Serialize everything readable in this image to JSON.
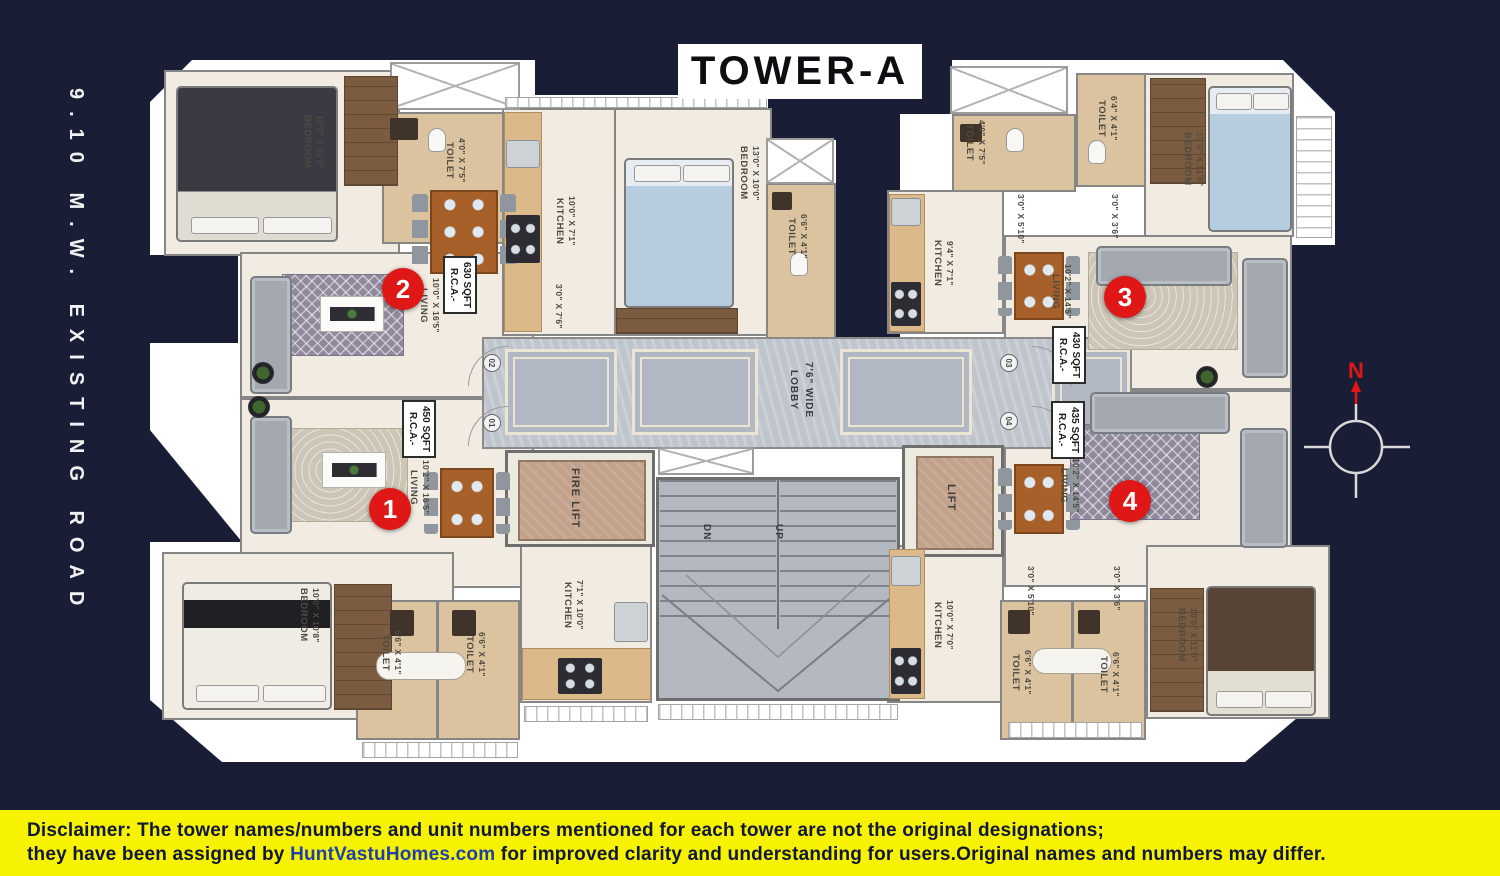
{
  "title": "TOWER-A",
  "road_label": "9.10 M.W. EXISTING ROAD",
  "compass": {
    "north": "N"
  },
  "markers": {
    "m1": "1",
    "m2": "2",
    "m3": "3",
    "m4": "4"
  },
  "doors": {
    "d01": "01",
    "d02": "02",
    "d03": "03",
    "d04": "04"
  },
  "core": {
    "lobby_name": "LOBBY",
    "lobby_dims": "7'6\" WIDE",
    "fire_lift": "FIRE LIFT",
    "lift": "LIFT",
    "stairs_dn": "DN",
    "stairs_up": "UP"
  },
  "rooms": {
    "bedroom_tl": {
      "name": "BEDROOM",
      "dims": "10'0\" X 12'0\""
    },
    "toilet_tl": {
      "name": "TOILET",
      "dims": "4'0\" X 7'5\""
    },
    "living_u2": {
      "name": "LIVING",
      "dims": "10'0\" X 16'5\""
    },
    "rca_u2": {
      "name": "R.C.A.-",
      "dims": "630 SQFT"
    },
    "kitchen_u2": {
      "name": "KITCHEN",
      "dims": "10'0\" X 7'1\""
    },
    "pass_u2": {
      "dims": "3'0\" X 7'6\""
    },
    "bedroom_tm": {
      "name": "BEDROOM",
      "dims": "13'0\" X 10'0\""
    },
    "toilet_tm": {
      "name": "TOILET",
      "dims": "6'6\" X 4'1\""
    },
    "toilet_tr1": {
      "name": "TOILET",
      "dims": "4'0\" X 7'5\""
    },
    "toilet_tr2": {
      "name": "TOILET",
      "dims": "6'4\" X 4'1\""
    },
    "bedroom_tr": {
      "name": "BEDROOM",
      "dims": "10'0\" X 11'0\""
    },
    "kitchen_u3": {
      "name": "KITCHEN",
      "dims": "9'4\" X 7'1\""
    },
    "pass_u3a": {
      "dims": "3'0\" X 5'10\""
    },
    "pass_u3b": {
      "dims": "3'0\" X 3'6\""
    },
    "living_u3": {
      "name": "LIVING",
      "dims": "10'2\" X 14'5\""
    },
    "rca_u3": {
      "name": "R.C.A.-",
      "dims": "430 SQFT"
    },
    "living_u1": {
      "name": "LIVING",
      "dims": "10'2\" X 16'5\""
    },
    "rca_u1": {
      "name": "R.C.A.-",
      "dims": "450 SQFT"
    },
    "living_u4": {
      "name": "LIVING",
      "dims": "10'2\" X 14'5\""
    },
    "rca_u4": {
      "name": "R.C.A.-",
      "dims": "435 SQFT"
    },
    "bedroom_bl": {
      "name": "BEDROOM",
      "dims": "10'0\" X 10'8\""
    },
    "toilet_bl1": {
      "name": "TOILET",
      "dims": "6'6\" X 4'1\""
    },
    "toilet_bl2": {
      "name": "TOILET",
      "dims": "6'6\" X 4'1\""
    },
    "kitchen_u1": {
      "name": "KITCHEN",
      "dims": "7'1\" X 10'0\""
    },
    "kitchen_u4": {
      "name": "KITCHEN",
      "dims": "10'0\" X 7'0\""
    },
    "pass_u4a": {
      "dims": "3'0\" X 5'10\""
    },
    "pass_u4b": {
      "dims": "3'0\" X 3'6\""
    },
    "toilet_br1": {
      "name": "TOILET",
      "dims": "6'6\" X 4'1\""
    },
    "toilet_br2": {
      "name": "TOILET",
      "dims": "6'6\" X 4'1\""
    },
    "bedroom_br": {
      "name": "BEDROOM",
      "dims": "10'0\" X 11'0\""
    }
  },
  "disclaimer": {
    "prefix": "Disclaimer:",
    "text1": " The tower names/numbers and unit numbers mentioned for each tower are not the original designations;",
    "text2": "they have been assigned by ",
    "link": "HuntVastuHomes.com",
    "text3": " for improved clarity and understanding for users.Original names and numbers may differ."
  },
  "colors": {
    "accent_red": "#e01717",
    "banner_yellow": "#f7f200",
    "navy": "#191d36",
    "link_blue": "#1d3fae"
  }
}
